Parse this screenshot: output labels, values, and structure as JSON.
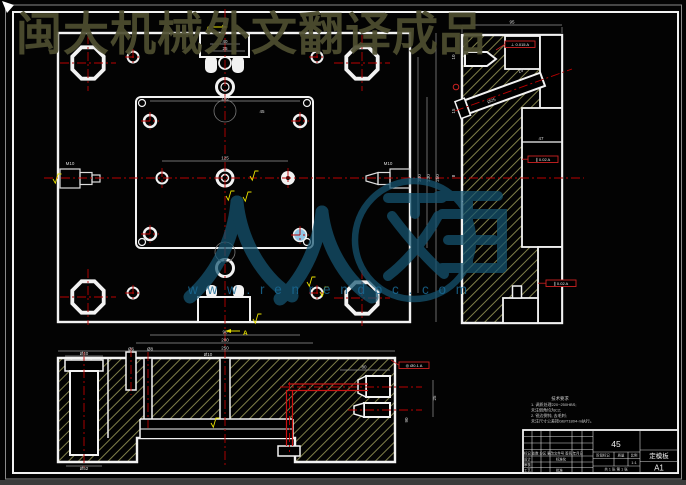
{
  "watermarks": {
    "top_text": "闽大机械外文翻译成品",
    "logo_text": "人人文库",
    "url": "w w w . r e n r e n d o c . c o m"
  },
  "section_marks": {
    "top": "A",
    "bottom": "A"
  },
  "dims": {
    "top_notch_w": "40",
    "top_notch_inner": "25",
    "inner_top": "160",
    "row_span": "125",
    "corner": "45",
    "right_v1": "200",
    "right_v2": "230",
    "right_v3": "250",
    "bot_1": "90",
    "bot_2": "200",
    "bot_3": "250",
    "plug_left": "M10",
    "plug_right": "M10",
    "sv_width": "95",
    "sv_d1": "10",
    "sv_d2": "15",
    "sv_d3": "8",
    "sv_slot": "Ø25",
    "sv_angle": "15°",
    "sv_pocket": "47",
    "bv_hole": "Ø40",
    "bv_slota": "Ø6",
    "bv_slotb": "Ø8",
    "bv_center": "Ø10",
    "bv_chan": "80",
    "bv_plug": "25",
    "bv_under": "Ø52",
    "bv_side": "90"
  },
  "gdt": {
    "f1": "⊥ 0.015 A",
    "f2": "∥ 0.02 A",
    "f3": "∥ 0.02 A",
    "f4": "◎ Ø0.1 A"
  },
  "notes": {
    "title": "技术要求",
    "line1": "1. 调质处理220~250HBS;",
    "line2": "未注倒角均为C2;",
    "line3": "2. 锐边倒钝, 去毛刺;",
    "line4": "未注尺寸公差按GB/T1804-m执行。"
  },
  "title_block": {
    "material": "45",
    "part_name": "定模板",
    "sheet_no": "A1",
    "header_row": "标记 处数 分区 更改文件号 签名 年月日",
    "design": "设计",
    "standardize": "标准化",
    "audit": "审核",
    "process": "工艺",
    "approve": "批准",
    "stage": "阶段标记",
    "weight": "质量",
    "scale_label": "比例",
    "scale": "1:1",
    "sheet_info": "共 1 张 第 1 张"
  }
}
